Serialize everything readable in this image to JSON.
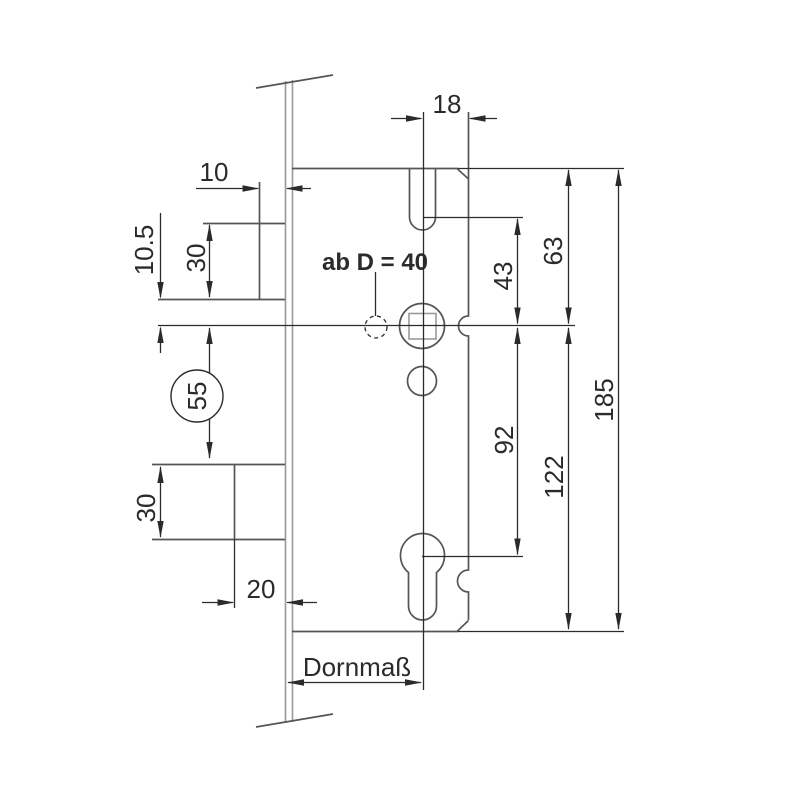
{
  "drawing": {
    "annotations": {
      "cylinder_note": "ab D = 40",
      "backset_label": "Dornmaß"
    },
    "dimensions": {
      "notch_center_to_edge": "18",
      "latch_projection": "10",
      "latch_bottom_to_axis": "10.5",
      "latch_height": "30",
      "axis_to_bolt_top_circled": "55",
      "bolt_height": "30",
      "bolt_projection": "20",
      "notch_to_axis": "43",
      "axis_to_cylinder": "92",
      "top_to_axis": "63",
      "axis_to_bottom": "122",
      "case_height": "185"
    },
    "colors": {
      "background": "#ffffff",
      "geometry": "#555555",
      "geometry_light": "#999999",
      "dimension": "#2b2b2b"
    }
  }
}
